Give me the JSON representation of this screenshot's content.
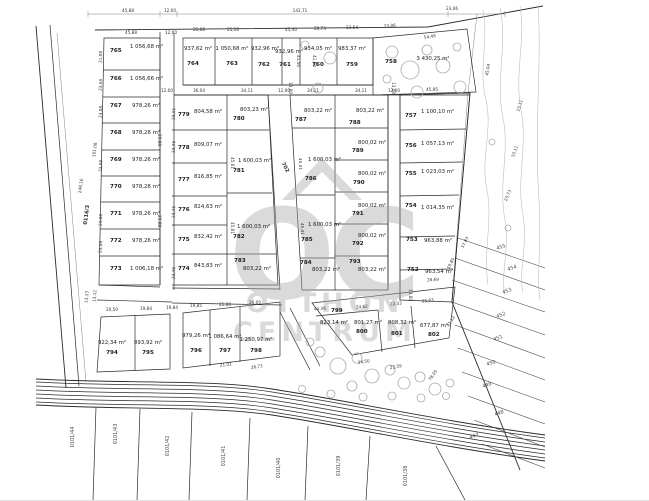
{
  "watermark": {
    "initials": "OC",
    "line1": "OTTHON",
    "line2": "CENTRUM"
  },
  "roads": {
    "left_road": "0116/3",
    "middle_road": "702"
  },
  "parcels": [
    {
      "id": "752",
      "area": "963,54 m²"
    },
    {
      "id": "753",
      "area": "963,88 m²"
    },
    {
      "id": "754",
      "area": "1 014,35 m²"
    },
    {
      "id": "755",
      "area": "1 023,03 m²"
    },
    {
      "id": "756",
      "area": "1 057,13 m²"
    },
    {
      "id": "757",
      "area": "1 100,10 m²"
    },
    {
      "id": "758",
      "area": "3 430,25 m²"
    },
    {
      "id": "759",
      "area": "983,37 m²"
    },
    {
      "id": "760",
      "area": "934,05 m²"
    },
    {
      "id": "761",
      "area": "932,96 m²"
    },
    {
      "id": "762",
      "area": "932,96 m²"
    },
    {
      "id": "763",
      "area": "1 050,68 m²"
    },
    {
      "id": "764",
      "area": "937,62 m²"
    },
    {
      "id": "765",
      "area": "1 056,68 m²"
    },
    {
      "id": "766",
      "area": "1 056,66 m²"
    },
    {
      "id": "767",
      "area": "978,26 m²"
    },
    {
      "id": "768",
      "area": "978,28 m²"
    },
    {
      "id": "769",
      "area": "978,26 m²"
    },
    {
      "id": "770",
      "area": "978,28 m²"
    },
    {
      "id": "771",
      "area": "978,26 m²"
    },
    {
      "id": "772",
      "area": "978,26 m²"
    },
    {
      "id": "773",
      "area": "1 006,18 m²"
    },
    {
      "id": "774",
      "area": "843,83 m²"
    },
    {
      "id": "775",
      "area": "832,42 m²"
    },
    {
      "id": "776",
      "area": "824,63 m²"
    },
    {
      "id": "777",
      "area": "816,85 m²"
    },
    {
      "id": "778",
      "area": "809,07 m²"
    },
    {
      "id": "779",
      "area": "804,58 m²"
    },
    {
      "id": "780",
      "area": "803,23 m²"
    },
    {
      "id": "781",
      "area": "1 600,03 m²"
    },
    {
      "id": "782",
      "area": "1 600,03 m²"
    },
    {
      "id": "783",
      "area": "803,22 m²"
    },
    {
      "id": "784",
      "area": "803,22 m²"
    },
    {
      "id": "785",
      "area": "1 600,03 m²"
    },
    {
      "id": "786",
      "area": "1 600,03 m²"
    },
    {
      "id": "787",
      "area": "803,22 m²"
    },
    {
      "id": "788",
      "area": "803,22 m²"
    },
    {
      "id": "789",
      "area": "800,02 m²"
    },
    {
      "id": "790",
      "area": "800,02 m²"
    },
    {
      "id": "791",
      "area": "800,02 m²"
    },
    {
      "id": "792",
      "area": "800,02 m²"
    },
    {
      "id": "793",
      "area": "803,22 m²"
    },
    {
      "id": "794",
      "area": "922,34 m²"
    },
    {
      "id": "795",
      "area": "893,92 m²"
    },
    {
      "id": "796",
      "area": "979,26 m²"
    },
    {
      "id": "797",
      "area": "1 086,64 m²"
    },
    {
      "id": "798",
      "area": "1 250,97 m²"
    },
    {
      "id": "799",
      "area": "823,14 m²"
    },
    {
      "id": "800",
      "area": "801,27 m²"
    },
    {
      "id": "801",
      "area": "808,32 m²"
    },
    {
      "id": "802",
      "area": "677,87 m²"
    }
  ],
  "strip_parcels": [
    "455",
    "454",
    "453",
    "452",
    "451",
    "450",
    "449",
    "448",
    "447"
  ],
  "south_parcels": [
    "0101/44",
    "0101/43",
    "0101/42",
    "0101/41",
    "0101/40",
    "0101/39",
    "0101/38"
  ],
  "dims": [
    "45,88",
    "12,00",
    "142,71",
    "23,06",
    "45,88",
    "12,00",
    "25,08",
    "25,56",
    "45,40",
    "20,73",
    "23,54",
    "23,06",
    "54,49",
    "161,08",
    "248,16",
    "36,04",
    "34,11",
    "12,00",
    "34,11",
    "34,11",
    "12,00",
    "45,95",
    "41,50",
    "13,00",
    "20,50",
    "19,84",
    "19,85",
    "21,00",
    "26,00",
    "44,36",
    "24,62",
    "22,33",
    "25,03",
    "28,69",
    "45,04",
    "23,11",
    "33,11",
    "23,73",
    "17,83",
    "19,85",
    "41,12",
    "78,05",
    "13,13",
    "13,12",
    "21,02",
    "26,73",
    "24,50",
    "22,59",
    "23,08",
    "21,08",
    "23,58",
    "45,01",
    "23,46"
  ]
}
